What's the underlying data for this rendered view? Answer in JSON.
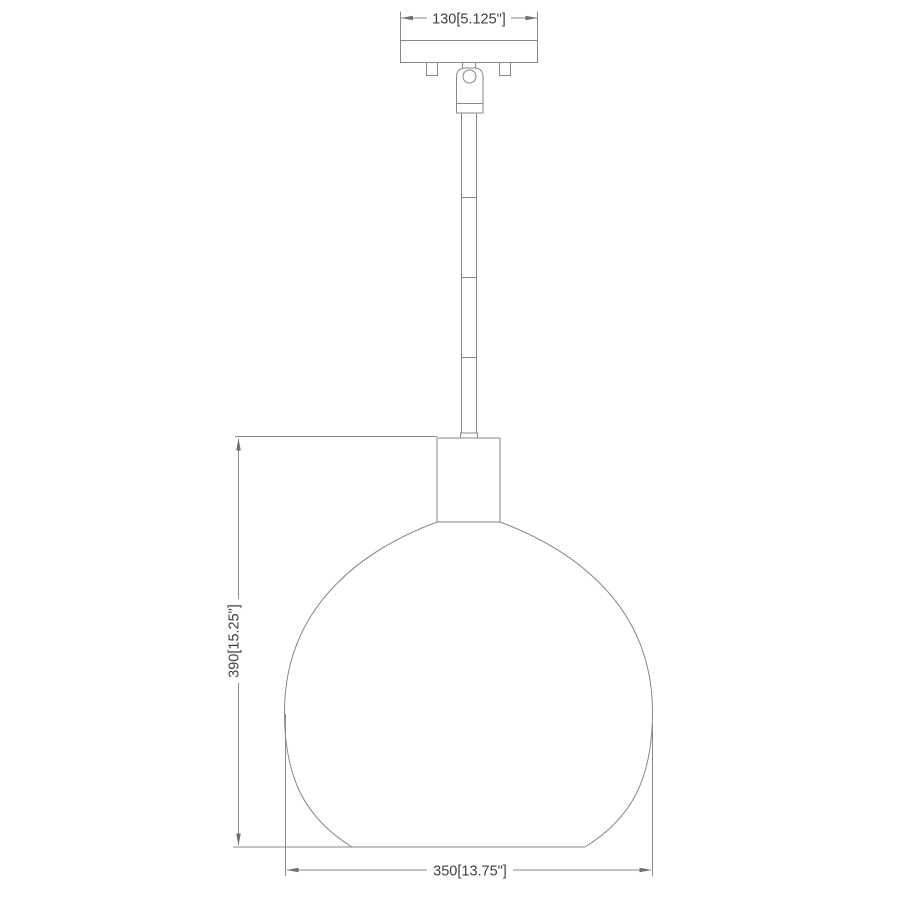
{
  "drawing": {
    "description": "pendant light fixture dimension drawing",
    "colors": {
      "background": "#ffffff",
      "line": "#878787",
      "dimension_line": "#8a8a8a",
      "label_text": "#3f3f3f"
    },
    "dimensions": {
      "canopy_width": {
        "label": "130[5.125\"]",
        "mm": "130",
        "inches": "5.125\""
      },
      "fixture_height": {
        "label": "390[15.25\"]",
        "mm": "390",
        "inches": "15.25\""
      },
      "shade_diameter": {
        "label": "350[13.75\"]",
        "mm": "350",
        "inches": "13.75\""
      }
    }
  }
}
